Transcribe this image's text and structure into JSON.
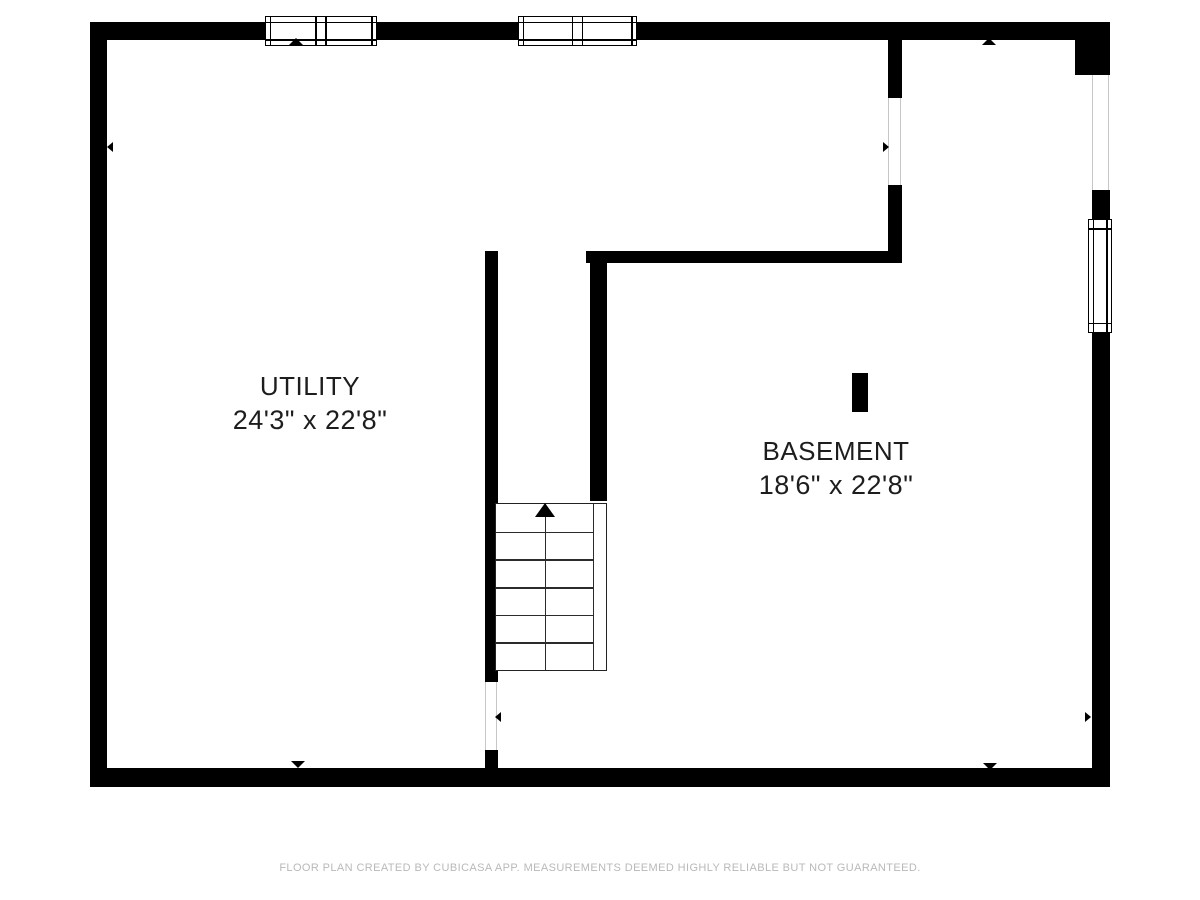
{
  "footer": {
    "text": "FLOOR PLAN CREATED BY CUBICASA APP. MEASUREMENTS DEEMED HIGHLY RELIABLE BUT NOT GUARANTEED."
  },
  "rooms": [
    {
      "name": "UTILITY",
      "dimensions": "24'3\" x 22'8\""
    },
    {
      "name": "BASEMENT",
      "dimensions": "18'6\" x 22'8\""
    }
  ],
  "stairs": {
    "steps": 6,
    "direction": "up"
  },
  "colors": {
    "wall": "#000000",
    "background": "#ffffff",
    "label_text": "#1d1d1d",
    "footer_text": "#b9b9b9",
    "opening_line": "#c6c6c6",
    "stair_line": "#2b2b2b"
  }
}
